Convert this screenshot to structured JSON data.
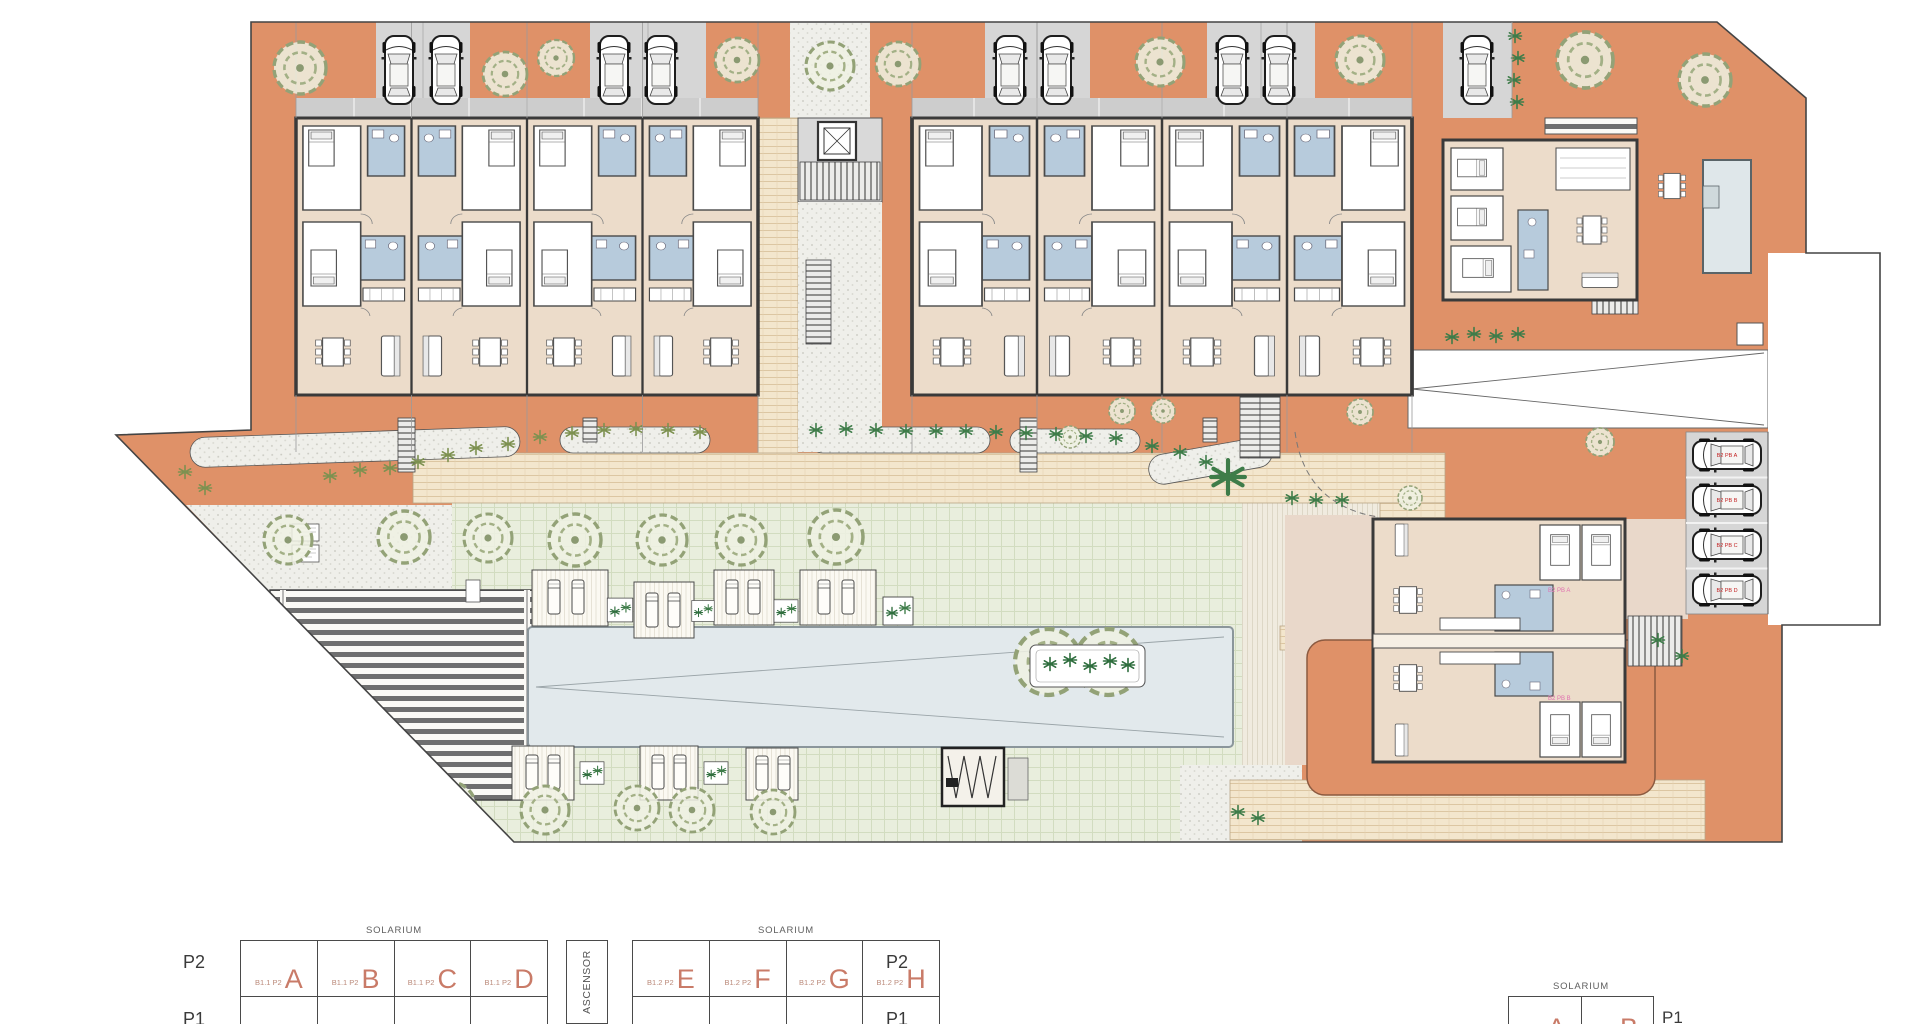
{
  "document": {
    "type": "architectural-site-plan",
    "sheet": "planta general"
  },
  "colors": {
    "terracotta": "#df9168",
    "paving_cream": "#f3e6cd",
    "lawn_green": "#e9eedd",
    "gravel": "#efefea",
    "pool_blue": "#e2e9ec",
    "parking_gray": "#d6d6d6",
    "interior_beige": "#ecdcca",
    "bathroom_blue": "#b7cbdc",
    "wall_dark": "#3a3a3a",
    "unit_letter_red": "#c97b68",
    "plant_green": "#3e7c49",
    "stall_label_red": "#c22020",
    "unit_tag_pink": "#e070b0"
  },
  "site": {
    "parking_stalls": [
      {
        "label": "B2 PB A"
      },
      {
        "label": "B2 PB B"
      },
      {
        "label": "B2 PB C"
      },
      {
        "label": "B2 PB D"
      }
    ],
    "unit_tags": [
      {
        "label": "B2 PB A"
      },
      {
        "label": "B2 PB B"
      }
    ]
  },
  "legend": {
    "elevator": "ASCENSOR",
    "left_block": {
      "solarium": "SOLARIUM",
      "rows": [
        {
          "floor": "P2",
          "cells": [
            {
              "prefix": "B1.1 P2",
              "letter": "A"
            },
            {
              "prefix": "B1.1 P2",
              "letter": "B"
            },
            {
              "prefix": "B1.1 P2",
              "letter": "C"
            },
            {
              "prefix": "B1.1 P2",
              "letter": "D"
            }
          ]
        },
        {
          "floor": "P1",
          "cells": [
            {
              "prefix": "B1.1 P1",
              "letter": "A"
            },
            {
              "prefix": "B1.1 P1",
              "letter": "B"
            },
            {
              "prefix": "B1.1 P1",
              "letter": "C"
            },
            {
              "prefix": "B1.1 P1",
              "letter": "D"
            }
          ]
        }
      ]
    },
    "right_block": {
      "solarium": "SOLARIUM",
      "rows": [
        {
          "floor": "P2",
          "cells": [
            {
              "prefix": "B1.2 P2",
              "letter": "E"
            },
            {
              "prefix": "B1.2 P2",
              "letter": "F"
            },
            {
              "prefix": "B1.2 P2",
              "letter": "G"
            },
            {
              "prefix": "B1.2 P2",
              "letter": "H"
            }
          ]
        },
        {
          "floor": "P1",
          "cells": [
            {
              "prefix": "B1.2 P1",
              "letter": "E"
            },
            {
              "prefix": "B1.2 P1",
              "letter": "F"
            },
            {
              "prefix": "B1.2 P1",
              "letter": "G"
            },
            {
              "prefix": "B1.2 P1",
              "letter": "H"
            }
          ]
        }
      ]
    },
    "mini_block": {
      "solarium": "SOLARIUM",
      "rows": [
        {
          "floor": "P1",
          "cells": [
            {
              "prefix": "B2 P1",
              "letter": "A"
            },
            {
              "prefix": "B2 P1",
              "letter": "B"
            }
          ]
        }
      ]
    }
  }
}
